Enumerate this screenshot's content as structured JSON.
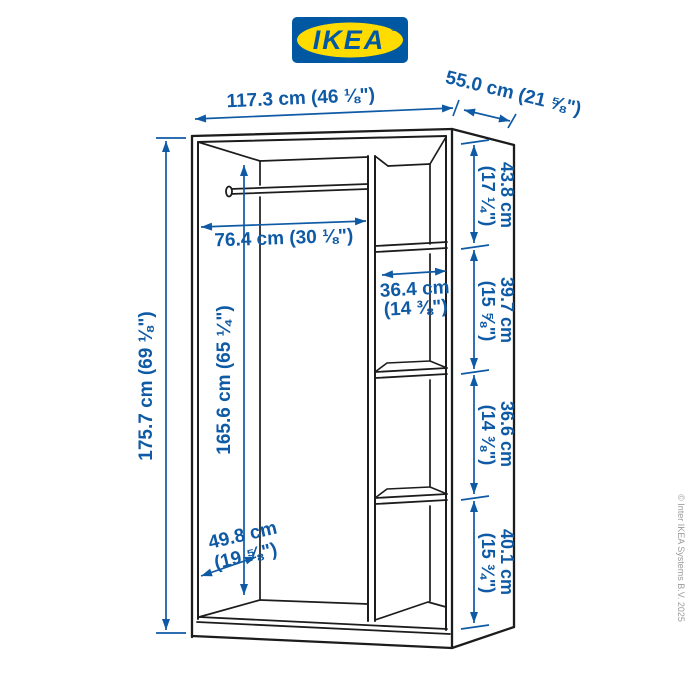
{
  "logo": {
    "text": "IKEA",
    "registered": "®"
  },
  "diagram": {
    "product": "wardrobe-frame-with-rail-and-shelves",
    "dimensions": {
      "width": "117.3 cm (46 ⅛\")",
      "depth": "55.0 cm (21 ⅝\")",
      "height": "175.7 cm (69 ⅛\")",
      "interior_height": "165.6 cm (65 ¼\")",
      "rail_width": "76.4 cm (30 ⅛\")",
      "shelf_width_line1": "36.4 cm",
      "shelf_width_line2": "(14 ⅜\")",
      "interior_depth_line1": "49.8 cm",
      "interior_depth_line2": "(19 ⅝\")",
      "right_segments": [
        {
          "line1": "43.8 cm",
          "line2": "(17 ¼\")"
        },
        {
          "line1": "39.7 cm",
          "line2": "(15 ⅝\")"
        },
        {
          "line1": "36.6 cm",
          "line2": "(14 ⅜\")"
        },
        {
          "line1": "40.1 cm",
          "line2": "(15 ¾\")"
        }
      ]
    }
  },
  "footer": {
    "copyright": "© Inter IKEA Systems B.V. 2025"
  },
  "colors": {
    "ikea_blue": "#0058A3",
    "ikea_yellow": "#FFDB00",
    "dimension_blue": "#0f5aa5",
    "line_black": "#1c1c1c",
    "copyright_gray": "#9b9b9b"
  }
}
